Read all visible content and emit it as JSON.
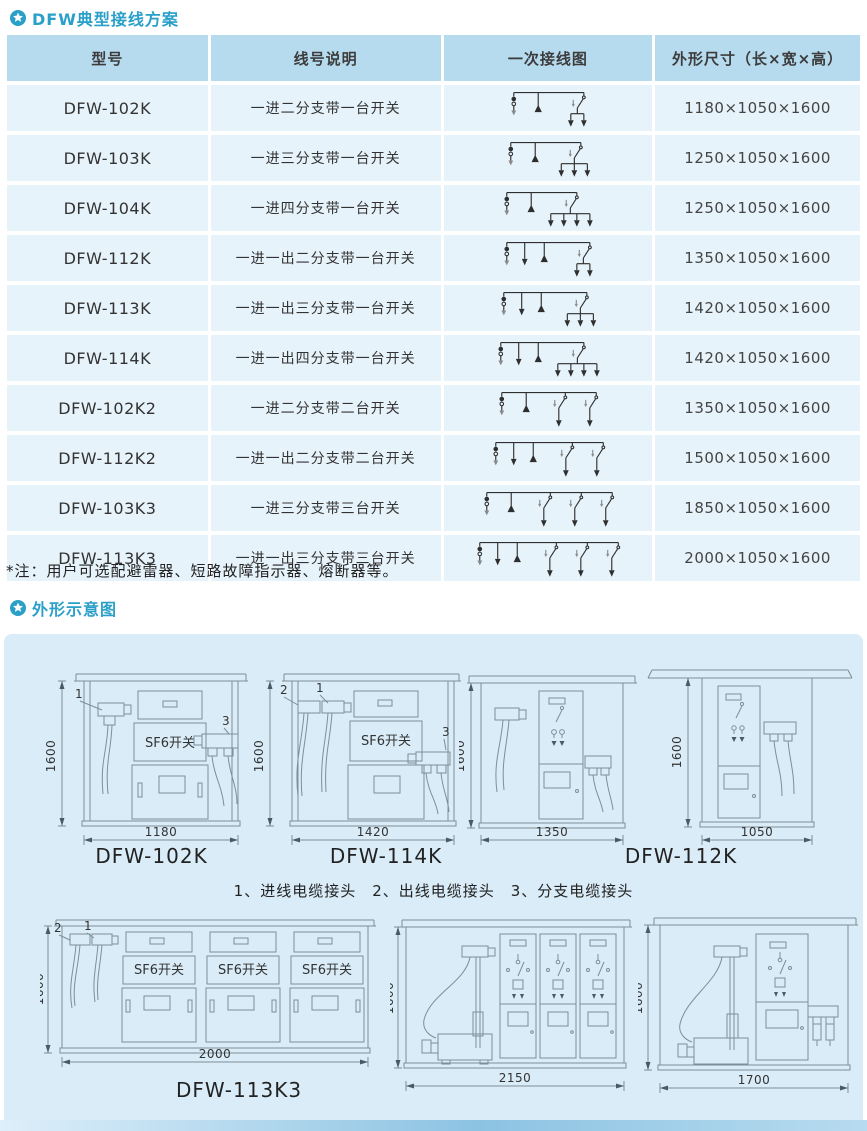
{
  "page": {
    "section1_title": "DFW典型接线方案",
    "section2_title": "外形示意图",
    "note": "*注：用户可选配避雷器、短路故障指示器、熔断器等。"
  },
  "colors": {
    "accent": "#2aa0c9",
    "table_header_bg": "#b7dbee",
    "table_row_bg": "#e7f3fb",
    "panel_bg": "#d9ecf7",
    "drawing_line": "#7e8e99"
  },
  "table": {
    "headers": [
      "型号",
      "线号说明",
      "一次接线图",
      "外形尺寸（长×宽×高）"
    ],
    "rows": [
      {
        "model": "DFW-102K",
        "desc": "一进二分支带一台开关",
        "dims": "1180×1050×1600",
        "diagram": {
          "out": 0,
          "switches": 1,
          "branches": 2
        }
      },
      {
        "model": "DFW-103K",
        "desc": "一进三分支带一台开关",
        "dims": "1250×1050×1600",
        "diagram": {
          "out": 0,
          "switches": 1,
          "branches": 3
        }
      },
      {
        "model": "DFW-104K",
        "desc": "一进四分支带一台开关",
        "dims": "1250×1050×1600",
        "diagram": {
          "out": 0,
          "switches": 1,
          "branches": 4
        }
      },
      {
        "model": "DFW-112K",
        "desc": "一进一出二分支带一台开关",
        "dims": "1350×1050×1600",
        "diagram": {
          "out": 1,
          "switches": 1,
          "branches": 2
        }
      },
      {
        "model": "DFW-113K",
        "desc": "一进一出三分支带一台开关",
        "dims": "1420×1050×1600",
        "diagram": {
          "out": 1,
          "switches": 1,
          "branches": 3
        }
      },
      {
        "model": "DFW-114K",
        "desc": "一进一出四分支带一台开关",
        "dims": "1420×1050×1600",
        "diagram": {
          "out": 1,
          "switches": 1,
          "branches": 4
        }
      },
      {
        "model": "DFW-102K2",
        "desc": "一进二分支带二台开关",
        "dims": "1350×1050×1600",
        "diagram": {
          "out": 0,
          "switches": 2,
          "branches": 1
        }
      },
      {
        "model": "DFW-112K2",
        "desc": "一进一出二分支带二台开关",
        "dims": "1500×1050×1600",
        "diagram": {
          "out": 1,
          "switches": 2,
          "branches": 1
        }
      },
      {
        "model": "DFW-103K3",
        "desc": "一进三分支带三台开关",
        "dims": "1850×1050×1600",
        "diagram": {
          "out": 0,
          "switches": 3,
          "branches": 1
        }
      },
      {
        "model": "DFW-113K3",
        "desc": "一进一出三分支带三台开关",
        "dims": "2000×1050×1600",
        "diagram": {
          "out": 1,
          "switches": 3,
          "branches": 1
        }
      }
    ]
  },
  "drawings": {
    "legend": "1、进线电缆接头　2、出线电缆接头　3、分支电缆接头",
    "a": {
      "caption": "DFW-102K",
      "h": "1600",
      "w": "1180",
      "sf6": "SF6开关",
      "c1": "1",
      "c3": "3"
    },
    "b": {
      "caption": "DFW-114K",
      "h": "1600",
      "w": "1420",
      "sf6": "SF6开关",
      "c1": "1",
      "c2": "2",
      "c3": "3"
    },
    "c": {
      "caption": "DFW-112K",
      "h": "1600",
      "w": "1350"
    },
    "d": {
      "h": "1600",
      "w": "1050"
    },
    "e": {
      "caption": "DFW-113K3",
      "h": "1600",
      "w": "2000",
      "sf6": "SF6开关",
      "c1": "1",
      "c2": "2"
    },
    "f": {
      "h": "1600",
      "w": "2150"
    },
    "g": {
      "h": "1600",
      "w": "1700"
    }
  }
}
